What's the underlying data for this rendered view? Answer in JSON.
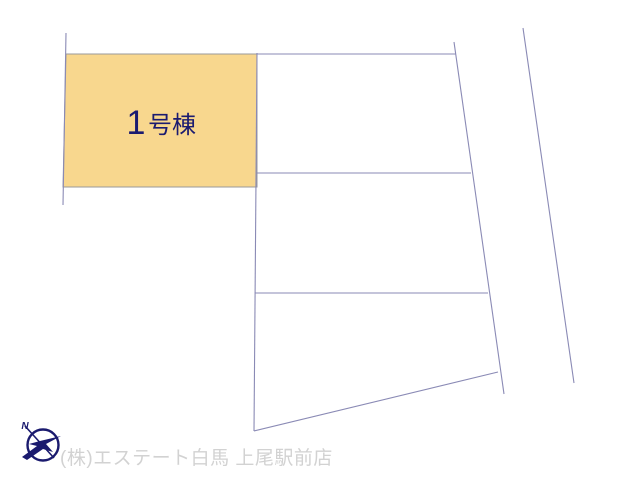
{
  "site_plan": {
    "background": "#FFFFFF",
    "line_color": "#8A8AB5",
    "highlight_parcel": {
      "label_number": "1",
      "label_suffix": "号棟",
      "label_color": "#1B1B70",
      "points": "66,54 257,54 257,187 63,187",
      "fill": "#F8D78E",
      "stroke": "#9A9A9A"
    },
    "boundary_lines": [
      {
        "name": "left-boundary-line",
        "x1": 66,
        "y1": 33,
        "x2": 63,
        "y2": 205
      },
      {
        "name": "parcels-left-edge-line",
        "x1": 257,
        "y1": 53,
        "x2": 254,
        "y2": 431
      },
      {
        "name": "parcel-a-top-line",
        "x1": 257,
        "y1": 54,
        "x2": 456,
        "y2": 54
      },
      {
        "name": "divider-a-b-line",
        "x1": 257,
        "y1": 173,
        "x2": 471,
        "y2": 173
      },
      {
        "name": "divider-b-c-line",
        "x1": 255,
        "y1": 293,
        "x2": 488,
        "y2": 293
      },
      {
        "name": "parcel-c-bottom-line",
        "x1": 254,
        "y1": 431,
        "x2": 498,
        "y2": 372
      },
      {
        "name": "right-boundary-line",
        "x1": 454,
        "y1": 42,
        "x2": 504,
        "y2": 394
      },
      {
        "name": "road-boundary-line",
        "x1": 523,
        "y1": 28,
        "x2": 574,
        "y2": 383
      }
    ],
    "compass": {
      "label": "N",
      "color": "#1A1A6E"
    },
    "footer": {
      "company": "(株)エステート白馬 上尾駅前店",
      "color": "#D2D2D2"
    }
  }
}
